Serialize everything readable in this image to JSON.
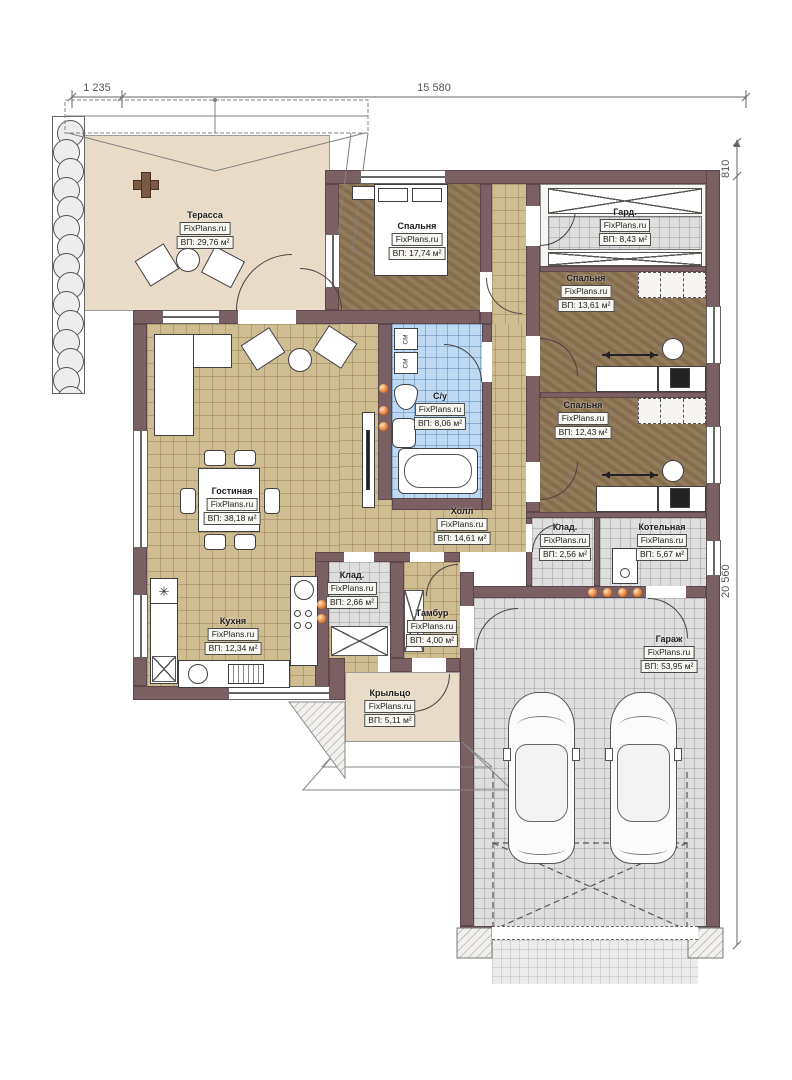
{
  "watermark": "FixPlans.ru",
  "dimensions": {
    "top_left": "1 235",
    "top_main": "15 580",
    "right_top": "810",
    "right_side": "20 560"
  },
  "rooms": {
    "terrace": {
      "name": "Терасса",
      "area": "ВП: 29,76 м²"
    },
    "bedroom_top": {
      "name": "Спальня",
      "area": "ВП: 17,74 м²"
    },
    "wardrobe": {
      "name": "Гард.",
      "area": "ВП: 8,43 м²"
    },
    "bedroom_mid": {
      "name": "Спальня",
      "area": "ВП: 13,61 м²"
    },
    "bathroom": {
      "name": "С/у",
      "area": "ВП: 8,06 м²"
    },
    "bedroom_low": {
      "name": "Спальня",
      "area": "ВП: 12,43 м²"
    },
    "living": {
      "name": "Гостиная",
      "area": "ВП: 38,18 м²"
    },
    "hall": {
      "name": "Холл",
      "area": "ВП: 14,61 м²"
    },
    "kitchen": {
      "name": "Кухня",
      "area": "ВП: 12,34 м²"
    },
    "storage_kitchen": {
      "name": "Клад.",
      "area": "ВП: 2,66 м²"
    },
    "vestibule": {
      "name": "Тамбур",
      "area": "ВП: 4,00 м²"
    },
    "storage_hall": {
      "name": "Клад.",
      "area": "ВП: 2,56 м²"
    },
    "boiler": {
      "name": "Котельная",
      "area": "ВП: 5,67 м²"
    },
    "porch": {
      "name": "Крыльцо",
      "area": "ВП: 5,11 м²"
    },
    "garage": {
      "name": "Гараж",
      "area": "ВП: 53,95 м²"
    }
  },
  "appliances": {
    "washing_machine": "СМ"
  },
  "symbols": {
    "fridge_star": "✳"
  },
  "colors": {
    "wall": "#7b6063",
    "floor_tan": "#cfbd92",
    "floor_brown": "#8c7452",
    "floor_blue": "#bedaf3",
    "floor_grey": "#dedede",
    "floor_beige": "#e8dcc9",
    "downlight_accent": "#e2762c"
  }
}
